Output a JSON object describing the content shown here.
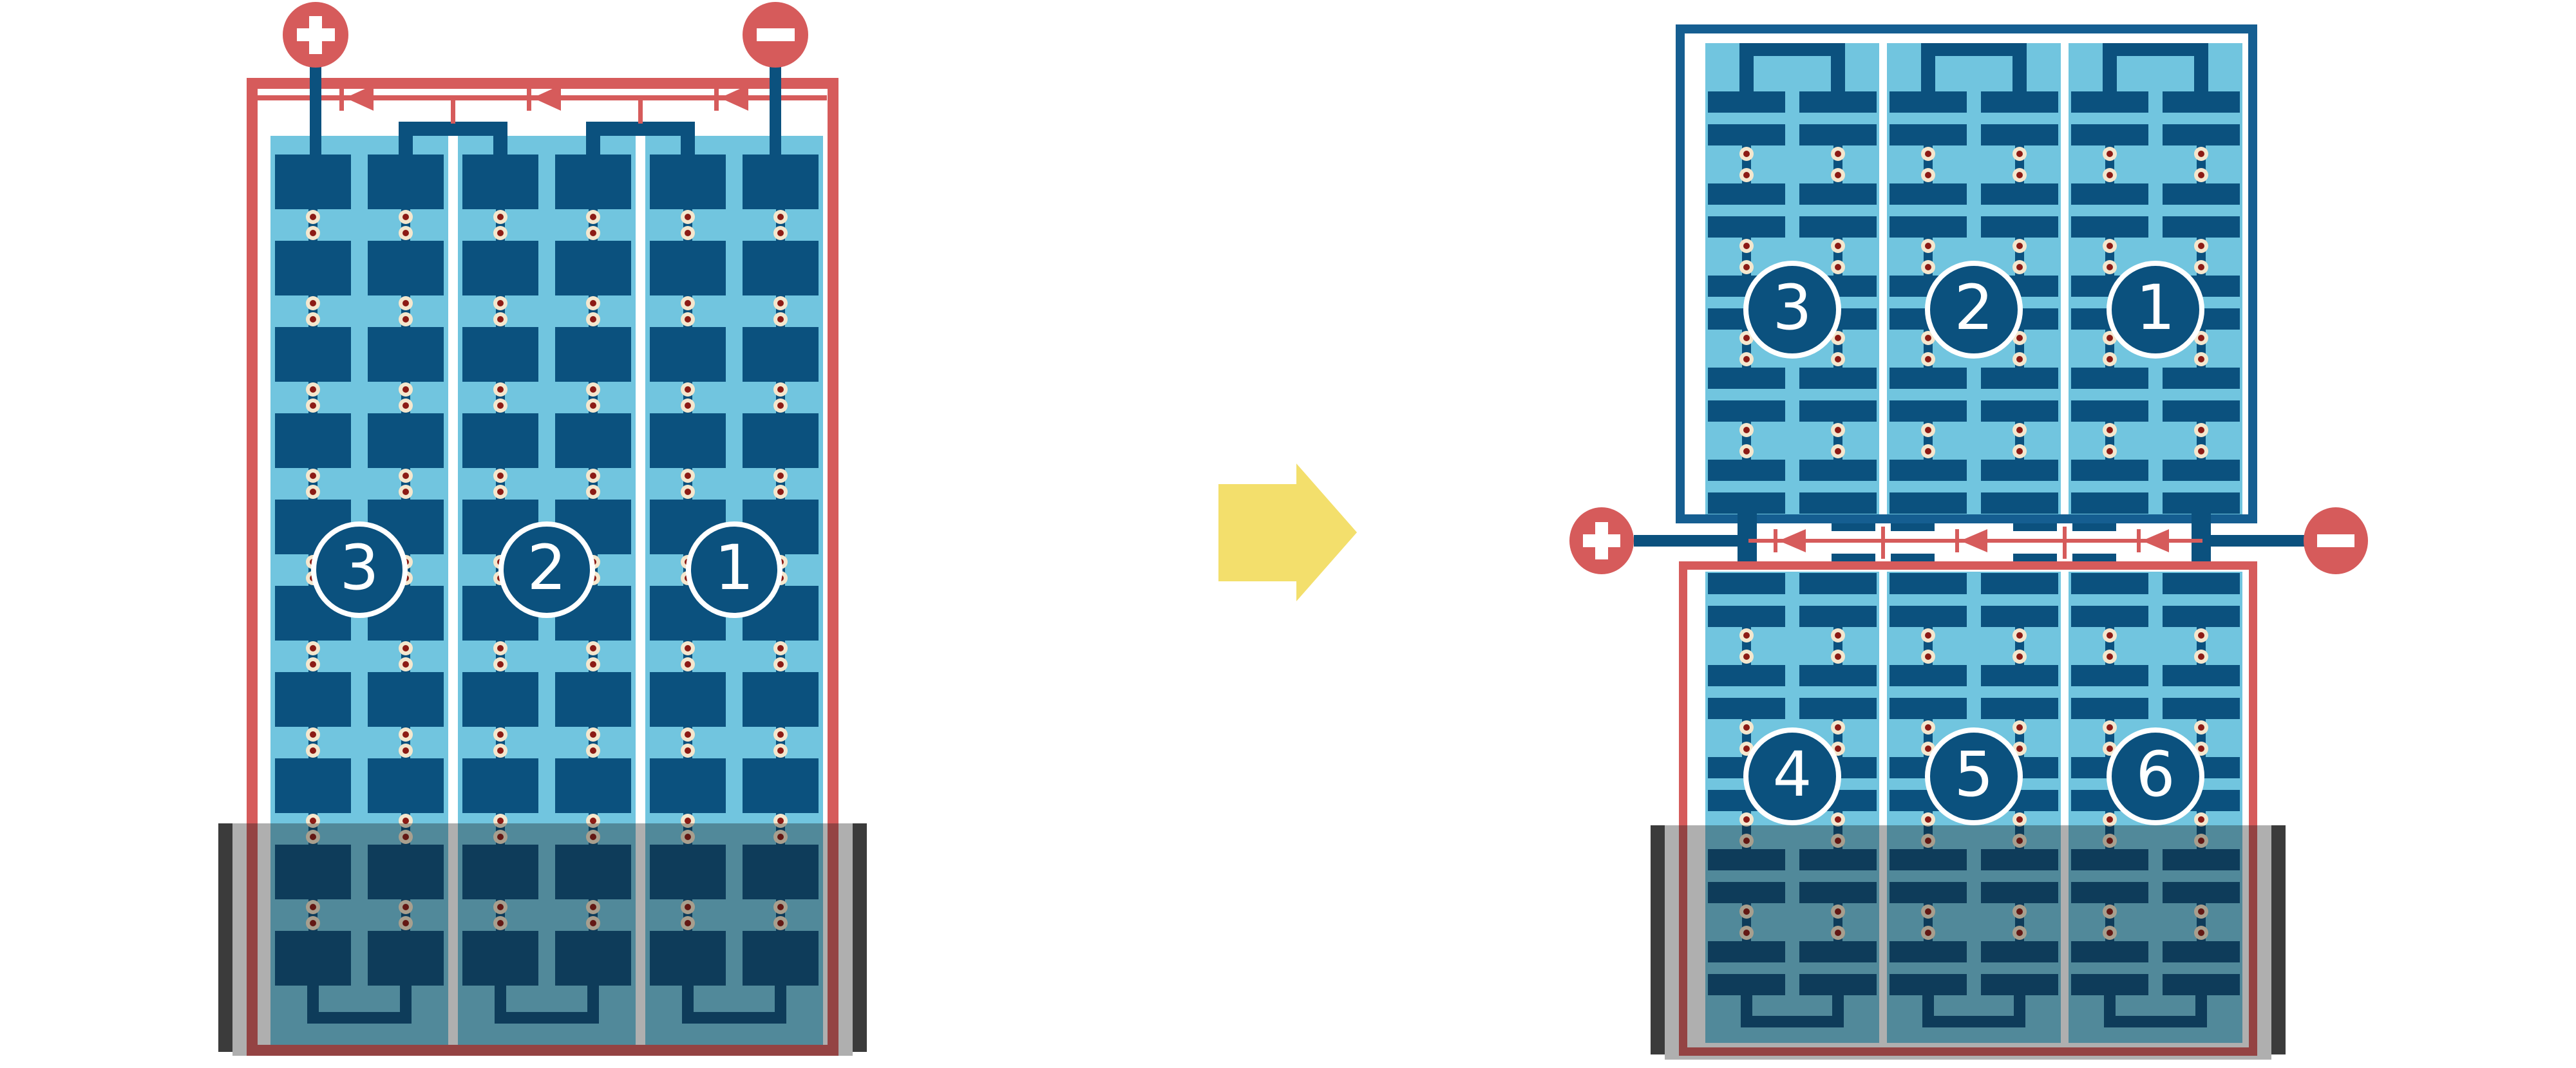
{
  "colors": {
    "red": "#D65B5B",
    "navy": "#0B517E",
    "frame_blue": "#155E91",
    "light_blue": "#71C5DF",
    "solder_ring": "#F4E7CE",
    "solder_core": "#8C1B15",
    "shade_bar": "#3B3B3B",
    "shade_overlay": "rgba(20,20,20,0.34)",
    "arrow_yellow": "#F3DF6C",
    "badge_text": "#FFFFFF",
    "separator_white": "#FFFFFF"
  },
  "left_module": {
    "terminal_positive": "+",
    "terminal_negative": "−",
    "terminal_positive_icon": "plus-icon",
    "terminal_negative_icon": "minus-icon",
    "strings": [
      {
        "label": "3"
      },
      {
        "label": "2"
      },
      {
        "label": "1"
      }
    ],
    "bypass_diode_count": 3,
    "shaded_bottom": true
  },
  "right_module": {
    "terminal_positive": "+",
    "terminal_negative": "−",
    "terminal_positive_icon": "plus-icon",
    "terminal_negative_icon": "minus-icon",
    "top_strings": [
      {
        "label": "3"
      },
      {
        "label": "2"
      },
      {
        "label": "1"
      }
    ],
    "bottom_strings": [
      {
        "label": "4"
      },
      {
        "label": "5"
      },
      {
        "label": "6"
      }
    ],
    "bypass_diode_count": 3,
    "shaded_bottom": true
  }
}
